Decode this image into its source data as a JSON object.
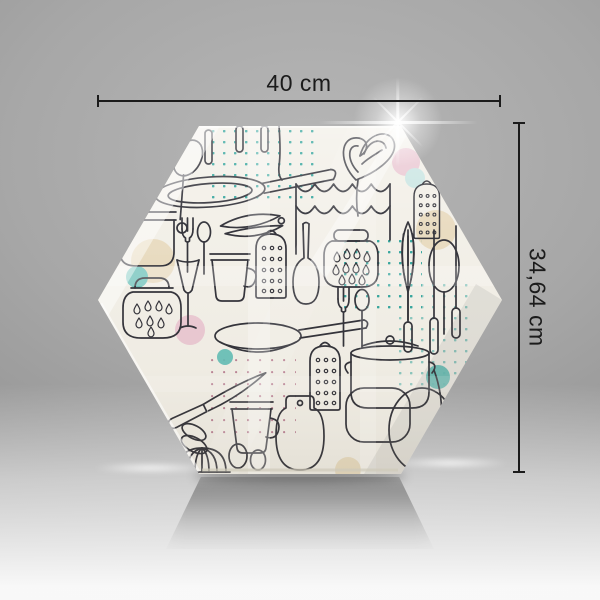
{
  "image": {
    "type": "studio product photo",
    "subject": "Hexagonal glass chopping board with kitchen utensil doodle pattern",
    "background": "grey gradient studio backdrop with light floor and soft shadow"
  },
  "dimensions": {
    "width_label": "40 cm",
    "height_label": "34,64 cm"
  },
  "colors": {
    "dimension": "#1b1b1b",
    "backdrop_dark": "#868686",
    "backdrop_light": "#b6b6b6",
    "floor_light": "#f6f6f6",
    "board_base": "#f2efe7",
    "doodle_line": "#2b2b33",
    "teal": "#5cbcb4",
    "teal_dot": "#2fa39b",
    "pink": "#e9c2d0",
    "pink_dot": "#b97f93",
    "beige": "#e7d8ba",
    "light_blue": "#c5e4e2"
  },
  "pattern_elements": [
    "frying-pan",
    "saucepan",
    "stockpot",
    "grater",
    "jar",
    "canister",
    "mug",
    "fork",
    "spoon",
    "knife",
    "tongs",
    "heart-whisk",
    "spatula",
    "strainer",
    "cutting-board",
    "citrus-juicer",
    "citrus-reamer",
    "wine-glass",
    "cake-frosting-waves",
    "hanging-utensils",
    "polka-dot-patches",
    "pastel-circles"
  ]
}
